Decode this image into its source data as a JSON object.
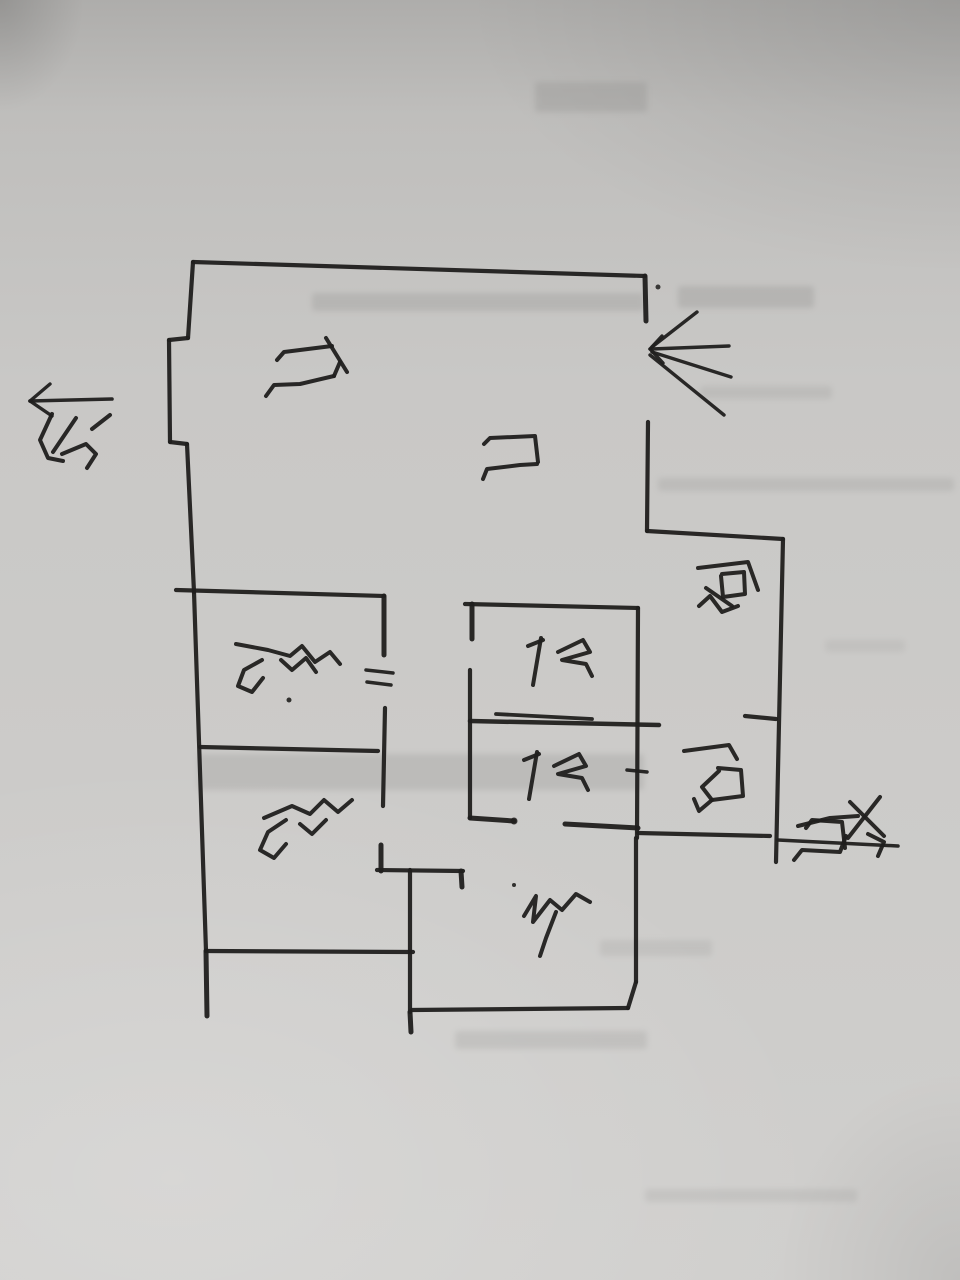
{
  "meta": {
    "description": "Photograph of a hand-drawn apartment floor-plan sketch in black marker on gray paper, drawing rotated 90 degrees clockwise",
    "orientation_note": "all handwriting appears rotated 90deg clockwise"
  },
  "palette": {
    "paper": "#c9c8c6",
    "ink": "#201f1d",
    "ghost_bleed": "#8f8e8c"
  },
  "north_indicator": {
    "label": "北",
    "meaning": "north",
    "arrow": {
      "shaft": [
        112,
        399,
        30,
        401
      ],
      "head": [
        [
          30,
          401,
          50,
          384
        ],
        [
          30,
          401,
          52,
          416
        ]
      ]
    }
  },
  "rooms": [
    {
      "id": "living-room",
      "label": "厅",
      "meaning": "living room / hall"
    },
    {
      "id": "entry-door",
      "label": "门",
      "meaning": "entry door"
    },
    {
      "id": "kitchen",
      "label": "厨",
      "meaning": "kitchen"
    },
    {
      "id": "master-bedroom",
      "label": "主卧",
      "meaning": "master bedroom"
    },
    {
      "id": "second-bedroom",
      "label": "次卧",
      "meaning": "second bedroom"
    },
    {
      "id": "bathroom-1",
      "label": "卫",
      "meaning": "bathroom 1"
    },
    {
      "id": "bathroom-2",
      "label": "卫",
      "meaning": "bathroom 2"
    },
    {
      "id": "balcony",
      "label": "阳",
      "meaning": "balcony off kitchen"
    },
    {
      "id": "bedroom-3",
      "label": "卧",
      "meaning": "third bedroom"
    },
    {
      "id": "opposite-door",
      "label": "对门",
      "meaning": "apartment across the corridor"
    }
  ],
  "labels": [
    {
      "id": "north",
      "text": "北",
      "strokes": [
        [
          [
            52,
            414
          ],
          [
            40,
            440
          ],
          [
            48,
            458
          ],
          [
            63,
            461
          ]
        ],
        [
          [
            76,
            418
          ],
          [
            53,
            452
          ]
        ],
        [
          [
            62,
            454
          ],
          [
            86,
            444
          ],
          [
            96,
            454
          ],
          [
            87,
            468
          ]
        ],
        [
          [
            92,
            429
          ],
          [
            110,
            415
          ]
        ]
      ]
    },
    {
      "id": "living-room",
      "text": "厅",
      "strokes": [
        [
          [
            277,
            360
          ],
          [
            284,
            352
          ],
          [
            332,
            346
          ]
        ],
        [
          [
            326,
            338
          ],
          [
            347,
            372
          ]
        ],
        [
          [
            266,
            396
          ],
          [
            274,
            385
          ],
          [
            300,
            384
          ],
          [
            334,
            376
          ]
        ],
        [
          [
            334,
            376
          ],
          [
            340,
            362
          ]
        ]
      ]
    },
    {
      "id": "entry-door",
      "text": "门",
      "strokes": [
        [
          [
            484,
            444
          ],
          [
            490,
            438
          ],
          [
            535,
            436
          ],
          [
            538,
            462
          ]
        ],
        [
          [
            483,
            479
          ],
          [
            487,
            469
          ],
          [
            520,
            465
          ],
          [
            537,
            464
          ]
        ]
      ]
    },
    {
      "id": "kitchen",
      "text": "厨",
      "strokes": [
        [
          [
            698,
            568
          ],
          [
            748,
            562
          ],
          [
            758,
            590
          ]
        ],
        [
          [
            722,
            574
          ],
          [
            744,
            572
          ],
          [
            745,
            594
          ],
          [
            723,
            597
          ],
          [
            721,
            576
          ]
        ],
        [
          [
            706,
            588
          ],
          [
            732,
            606
          ]
        ],
        [
          [
            699,
            606
          ],
          [
            710,
            596
          ],
          [
            722,
            612
          ],
          [
            738,
            606
          ]
        ]
      ]
    },
    {
      "id": "master-bedroom",
      "text": "主卧",
      "strokes": [
        [
          [
            236,
            644
          ],
          [
            268,
            650
          ],
          [
            290,
            656
          ],
          [
            302,
            646
          ],
          [
            315,
            662
          ],
          [
            330,
            652
          ],
          [
            340,
            664
          ]
        ],
        [
          [
            262,
            660
          ],
          [
            244,
            670
          ],
          [
            238,
            686
          ],
          [
            252,
            692
          ],
          [
            263,
            678
          ]
        ],
        [
          [
            281,
            660
          ],
          [
            292,
            670
          ],
          [
            306,
            658
          ],
          [
            316,
            672
          ]
        ]
      ],
      "dots": [
        [
          289,
          700,
          2.5
        ]
      ]
    },
    {
      "id": "second-bedroom",
      "text": "次卧",
      "strokes": [
        [
          [
            264,
            818
          ],
          [
            292,
            806
          ],
          [
            310,
            814
          ],
          [
            324,
            800
          ],
          [
            338,
            812
          ],
          [
            352,
            800
          ]
        ],
        [
          [
            286,
            820
          ],
          [
            268,
            832
          ],
          [
            260,
            850
          ],
          [
            274,
            858
          ],
          [
            286,
            844
          ]
        ],
        [
          [
            300,
            824
          ],
          [
            312,
            834
          ],
          [
            326,
            820
          ]
        ]
      ]
    },
    {
      "id": "bathroom-1",
      "text": "卫",
      "strokes": [
        [
          [
            528,
            646
          ],
          [
            543,
            640
          ]
        ],
        [
          [
            541,
            638
          ],
          [
            533,
            685
          ]
        ],
        [
          [
            558,
            652
          ],
          [
            583,
            640
          ],
          [
            590,
            652
          ],
          [
            562,
            660
          ],
          [
            586,
            664
          ],
          [
            592,
            676
          ]
        ]
      ]
    },
    {
      "id": "bathroom-2",
      "text": "卫",
      "strokes": [
        [
          [
            524,
            760
          ],
          [
            539,
            754
          ]
        ],
        [
          [
            537,
            752
          ],
          [
            529,
            799
          ]
        ],
        [
          [
            554,
            766
          ],
          [
            579,
            754
          ],
          [
            586,
            766
          ],
          [
            558,
            774
          ],
          [
            582,
            778
          ],
          [
            588,
            790
          ]
        ]
      ]
    },
    {
      "id": "balcony",
      "text": "阳",
      "strokes": [
        [
          [
            684,
            751
          ],
          [
            729,
            745
          ],
          [
            737,
            759
          ]
        ],
        [
          [
            718,
            768
          ],
          [
            741,
            770
          ],
          [
            743,
            796
          ],
          [
            712,
            800
          ],
          [
            702,
            787
          ],
          [
            719,
            771
          ]
        ],
        [
          [
            712,
            800
          ],
          [
            699,
            811
          ],
          [
            694,
            799
          ]
        ]
      ]
    },
    {
      "id": "bedroom-3",
      "text": "卧",
      "strokes": [
        [
          [
            524,
            916
          ],
          [
            536,
            896
          ],
          [
            533,
            922
          ],
          [
            550,
            900
          ],
          [
            562,
            910
          ],
          [
            576,
            894
          ],
          [
            590,
            902
          ]
        ],
        [
          [
            556,
            912
          ],
          [
            546,
            938
          ],
          [
            540,
            956
          ]
        ]
      ],
      "dots": [
        [
          514,
          885,
          2
        ]
      ]
    },
    {
      "id": "opposite-door",
      "text": "对门",
      "strokes": [
        [
          [
            850,
            802
          ],
          [
            884,
            836
          ]
        ],
        [
          [
            880,
            797
          ],
          [
            848,
            838
          ]
        ],
        [
          [
            798,
            826
          ],
          [
            830,
            818
          ],
          [
            858,
            816
          ]
        ],
        [
          [
            806,
            828
          ],
          [
            812,
            820
          ],
          [
            842,
            822
          ],
          [
            845,
            848
          ]
        ],
        [
          [
            794,
            860
          ],
          [
            802,
            850
          ],
          [
            840,
            852
          ],
          [
            846,
            836
          ]
        ],
        [
          [
            868,
            834
          ],
          [
            884,
            842
          ],
          [
            878,
            856
          ]
        ]
      ]
    }
  ],
  "walls": [
    [
      193,
      262,
      645,
      276
    ],
    [
      193,
      262,
      188,
      338
    ],
    [
      188,
      338,
      169,
      340
    ],
    [
      169,
      340,
      170,
      442
    ],
    [
      170,
      442,
      187,
      444
    ],
    [
      187,
      444,
      194,
      592
    ],
    [
      194,
      592,
      206,
      951
    ],
    [
      206,
      951,
      207,
      1016,
      5
    ],
    [
      645,
      276,
      646,
      321,
      5
    ],
    [
      648,
      422,
      647,
      531
    ],
    [
      647,
      531,
      783,
      539
    ],
    [
      783,
      539,
      776,
      862
    ],
    [
      745,
      716,
      776,
      719
    ],
    [
      638,
      833,
      770,
      836
    ],
    [
      778,
      840,
      898,
      846,
      3.5
    ],
    [
      465,
      604,
      638,
      608
    ],
    [
      472,
      604,
      472,
      639,
      5
    ],
    [
      470,
      670,
      470,
      818
    ],
    [
      470,
      818,
      514,
      821,
      5
    ],
    [
      565,
      824,
      638,
      828,
      5
    ],
    [
      470,
      721,
      659,
      725,
      4.5
    ],
    [
      496,
      714,
      592,
      719,
      3.8
    ],
    [
      638,
      608,
      637,
      838
    ],
    [
      627,
      770,
      647,
      772,
      3.5
    ],
    [
      176,
      590,
      384,
      596
    ],
    [
      384,
      596,
      384,
      655,
      5
    ],
    [
      366,
      670,
      393,
      673,
      3.5
    ],
    [
      367,
      682,
      391,
      685,
      3.5
    ],
    [
      385,
      708,
      383,
      806
    ],
    [
      200,
      747,
      378,
      751
    ],
    [
      381,
      845,
      381,
      871,
      5
    ],
    [
      377,
      870,
      463,
      871
    ],
    [
      461,
      871,
      462,
      887,
      5
    ],
    [
      206,
      951,
      413,
      952
    ],
    [
      410,
      870,
      410,
      1012
    ],
    [
      410,
      1012,
      411,
      1032,
      5
    ],
    [
      412,
      1010,
      628,
      1008
    ],
    [
      628,
      1008,
      636,
      982
    ],
    [
      636,
      838,
      636,
      982
    ]
  ],
  "door_fan": {
    "meaning": "entry door swing sketch at top-right opening",
    "lines": [
      [
        652,
        347,
        697,
        312
      ],
      [
        652,
        349,
        729,
        346
      ],
      [
        652,
        352,
        731,
        377
      ],
      [
        650,
        355,
        724,
        415
      ],
      [
        662,
        336,
        650,
        349
      ],
      [
        650,
        349,
        663,
        363
      ]
    ]
  },
  "dots": [
    [
      658,
      287,
      2.5
    ],
    [
      514,
      821,
      3.5
    ]
  ],
  "ghosts": [
    [
      535,
      82,
      112,
      30,
      0.3
    ],
    [
      312,
      293,
      332,
      18,
      0.28
    ],
    [
      678,
      286,
      136,
      22,
      0.3
    ],
    [
      700,
      386,
      132,
      13,
      0.2
    ],
    [
      658,
      478,
      296,
      13,
      0.22
    ],
    [
      198,
      754,
      446,
      36,
      0.26
    ],
    [
      600,
      940,
      112,
      16,
      0.18
    ],
    [
      455,
      1031,
      192,
      18,
      0.22
    ],
    [
      645,
      1189,
      212,
      13,
      0.18
    ],
    [
      825,
      640,
      80,
      12,
      0.15
    ]
  ]
}
